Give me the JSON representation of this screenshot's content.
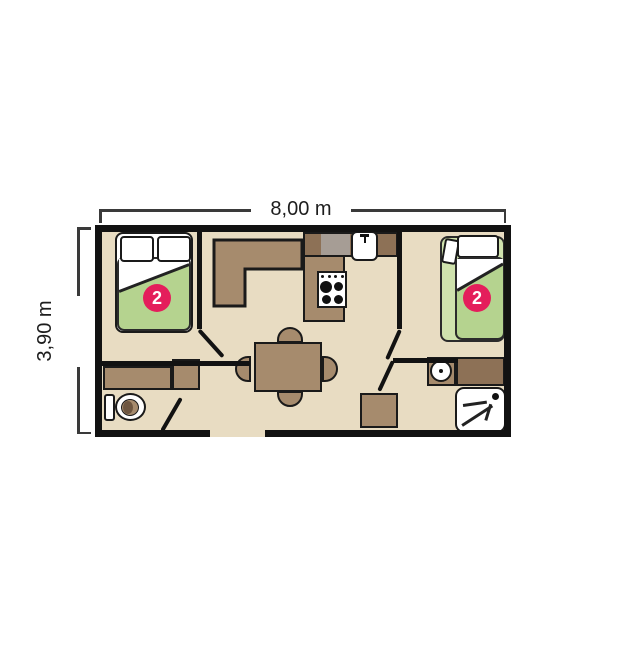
{
  "diagram": {
    "type": "mobile-home floor plan",
    "dimensions": {
      "width": {
        "label": "8,00 m"
      },
      "height": {
        "label": "3,90 m"
      }
    },
    "rooms": {
      "bedroom_left": {
        "name": "bedroom left",
        "capacity_badge": "2"
      },
      "bedroom_right": {
        "name": "bedroom right",
        "capacity_badge": "2"
      },
      "living_kitchen": {
        "name": "living room / kitchen"
      },
      "wc": {
        "name": "wc"
      },
      "bathroom": {
        "name": "shower room"
      }
    },
    "fixtures": [
      "double-bed-left",
      "bed-right",
      "pillows",
      "l-shaped-sofa",
      "kitchen-counter",
      "kitchen-sink",
      "stove-4-burners",
      "worktop-appliance",
      "dining-table",
      "chair-top",
      "chair-bottom",
      "chair-left",
      "chair-right",
      "wc-cabinet",
      "wardrobe-cabinet",
      "toilet",
      "washbasin",
      "bathroom-counter",
      "shower",
      "storage-cabinet",
      "door-bedroom-left",
      "door-bedroom-right",
      "door-wc",
      "door-bathroom",
      "entrance-opening"
    ],
    "colors": {
      "wall": "#121212",
      "floor": "#e8dcc2",
      "furniture": "#a68b6d",
      "furniture_dark": "#8d7156",
      "appliance_gray": "#a69d95",
      "bed_green": "#b5d38f",
      "bed_green_light": "#cfe2ad",
      "badge_pink": "#e41e5b",
      "dimension_text": "#1d1d1d"
    }
  }
}
